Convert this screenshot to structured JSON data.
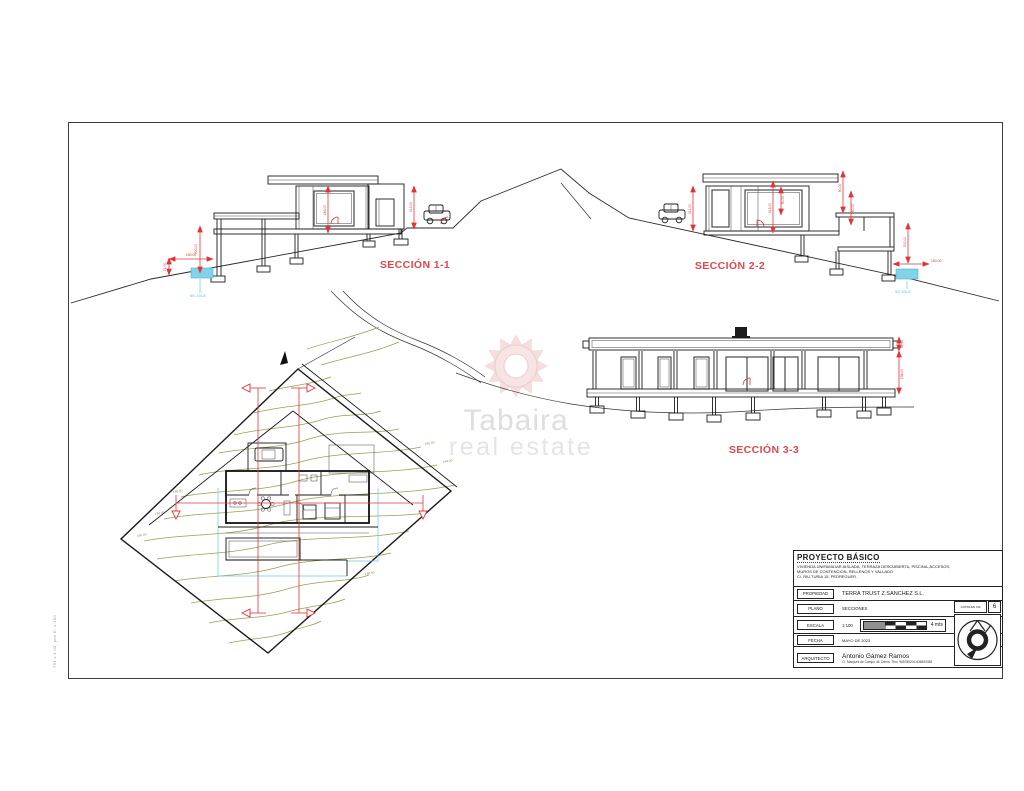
{
  "margin_note": "794 x 4 00. pml E: 1:100",
  "watermark": {
    "brand": "Tabaira",
    "tagline": "real estate"
  },
  "sections": {
    "s1": {
      "label": "SECCIÓN 1-1",
      "water_label": "NIV. AGUA",
      "dims": [
        "300.00",
        "150.00",
        "71.00",
        "283.00",
        "313.00"
      ]
    },
    "s2": {
      "label": "SECCIÓN 2-2",
      "water_label": "NIV. AGUA",
      "dims": [
        "311.00",
        "416.00",
        "50.00",
        "90.00",
        "360.00",
        "300.00",
        "150.00"
      ]
    },
    "s3": {
      "label": "SECCIÓN 3-3",
      "dims": [
        "30.00",
        "238.00"
      ]
    }
  },
  "siteplan": {
    "contour_labels": [
      "186.00",
      "188.00",
      "190.00",
      "192.00",
      "194.00",
      "196.00"
    ]
  },
  "titleblock": {
    "project_title": "PROYECTO BÁSICO",
    "project_desc1": "VIVIENDA UNIFAMILIAR AISLADA, TERRAZA DESCUBIERTA, PISCINA, ACCESOS,",
    "project_desc2": "MUROS DE CONTENCION, RELLENOS Y VALLADO",
    "project_desc3": "C/. RIU TURIA 15. PEDREGUER.",
    "propiedad_label": "PROPIEDAD",
    "propiedad_value": "TERRA TRUST Z.SANCHEZ S.L.",
    "plano_label": "PLANO",
    "plano_value": "SECCIONES",
    "cotas_label": "COTAS EN CM",
    "sheet_number": "6",
    "escala_label": "ESCALA",
    "escala_value": "1:100",
    "scale_units": "4  mts",
    "fecha_label": "FECHA",
    "fecha_value": "MAYO DE 2023",
    "arquitecto_label": "ARQUITECTO",
    "arquitecto_value": "Antonio Gámez Ramos",
    "arquitecto_info": "C/. Marqués de Campo 46. Dénia. Tfno. 965786201-636693384"
  },
  "colors": {
    "dim_red": "#e03438",
    "contour_olive": "#9a9c52",
    "pool_blue": "#82d2e8",
    "watermark_pink": "#e8b8b8"
  }
}
